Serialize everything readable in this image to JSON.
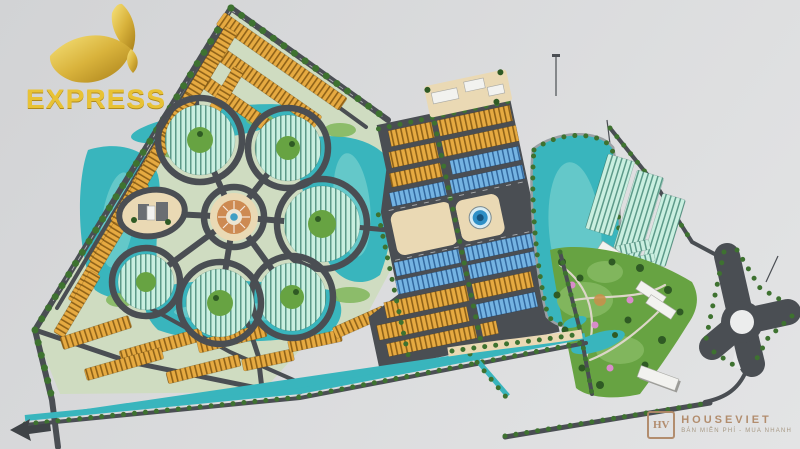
{
  "branding": {
    "express": {
      "label": "EXPRESS"
    },
    "houseviet": {
      "monogram": "HV",
      "title": "HOUSEVIET",
      "tagline": "BÁN MIỄN PHÍ - MUA NHANH"
    }
  },
  "colors": {
    "background_a": "#d2d3d5",
    "background_b": "#e3e4e5",
    "parcel": "#cfdcc1",
    "road": "#4a4e53",
    "road_light": "#9aa0a4",
    "water": "#39b5bd",
    "water_light": "#8fdcd6",
    "mint": "#c9efe0",
    "mint_dark": "#5d9a89",
    "orange": "#e6aa41",
    "orange_dark": "#8f6218",
    "blue": "#74b3e2",
    "blue_dark": "#33699f",
    "grass": "#84b860",
    "park": "#67a342",
    "tree": "#3e7230",
    "tree_dark": "#2f5a24",
    "sand": "#ead9b4",
    "plaza": "#cd8a52",
    "white_bldg": "#f2f2ef",
    "gold": "#e8c235",
    "gold_dark": "#b08a1d",
    "wm_text": "#b08968",
    "wm_sub": "#a3947e"
  }
}
